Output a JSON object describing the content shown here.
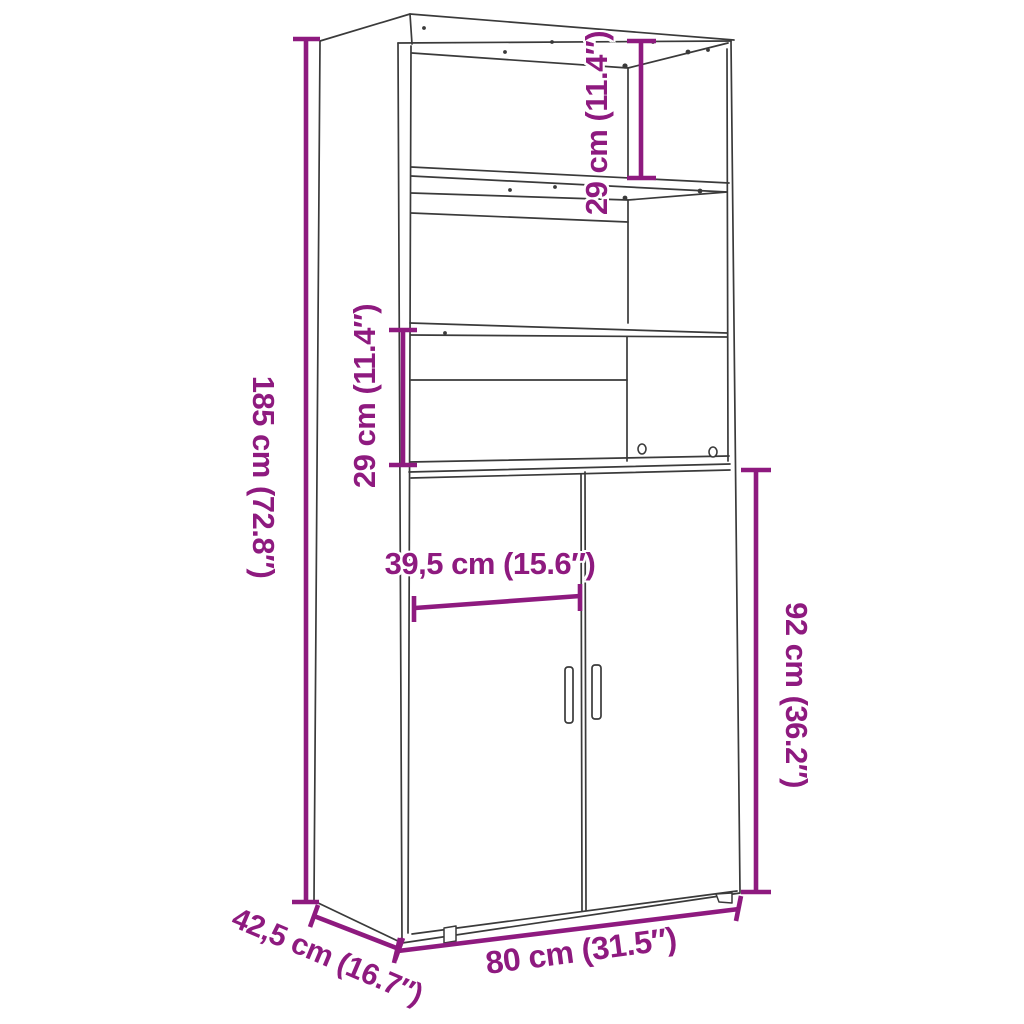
{
  "diagram": {
    "type": "furniture-dimension-drawing",
    "subject": "highboard-cabinet-with-shelves-and-two-doors",
    "colors": {
      "dimension": "#8E1A7F",
      "outline": "#3A3A3A",
      "background": "#FFFFFF"
    },
    "dimensions": {
      "total_height": "185 cm (72.8″)",
      "top_compartment_height": "29 cm (11.4″)",
      "middle_compartment_height": "29 cm (11.4″)",
      "door_width": "39,5 cm (15.6″)",
      "door_height": "92 cm (36.2″)",
      "total_width": "80 cm (31.5″)",
      "total_depth": "42,5 cm (16.7″)"
    }
  }
}
